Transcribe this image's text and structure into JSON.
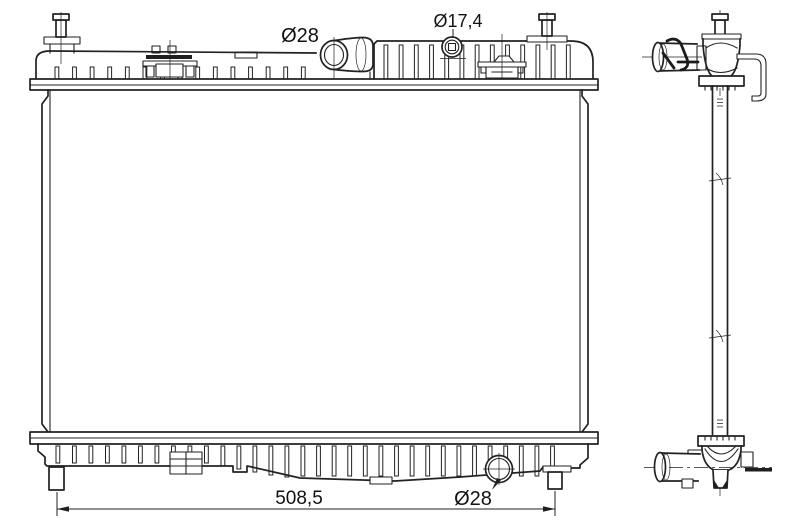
{
  "canvas": {
    "width": 800,
    "height": 531,
    "background": "#ffffff",
    "line_color": "#222222",
    "text_color": "#111111"
  },
  "drawing": {
    "subject": "radiator-technical-drawing",
    "views": {
      "front": "front view with top tank, core, bottom tank",
      "side": "side profile view with inlet and outlet pipes"
    },
    "labels": {
      "inlet_pipe_diameter": "Ø28",
      "filler_neck_diameter": "Ø17,4",
      "core_width": "508,5",
      "drain_plug_diameter": "Ø28"
    }
  }
}
